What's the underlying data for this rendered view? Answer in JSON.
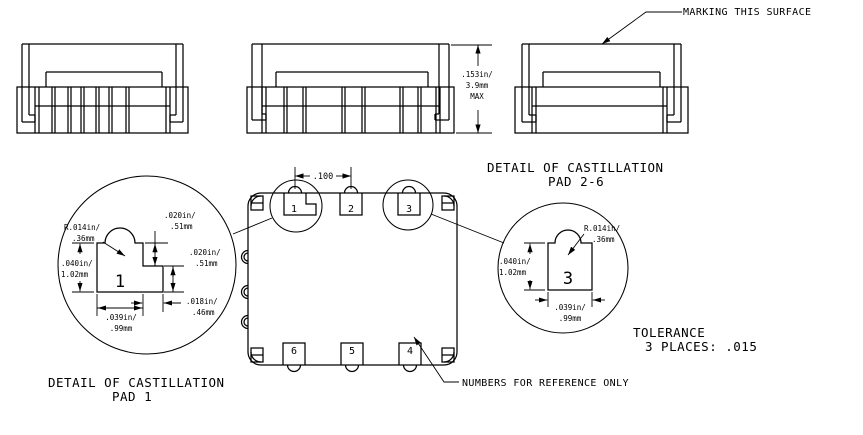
{
  "colors": {
    "line": "#000000",
    "background": "#ffffff"
  },
  "notes": {
    "marking": "MARKING THIS SURFACE",
    "reference": "NUMBERS FOR REFERENCE ONLY"
  },
  "tolerance": {
    "line1": "TOLERANCE",
    "line2": "3 PLACES: .015"
  },
  "height_dim": {
    "line1": ".153in/",
    "line2": "3.9mm",
    "line3": "MAX"
  },
  "pitch_dim": ".100",
  "plan_pads": {
    "p1": "1",
    "p2": "2",
    "p3": "3",
    "p4": "4",
    "p5": "5",
    "p6": "6"
  },
  "detail_pad1": {
    "title": "DETAIL OF CASTILLATION",
    "subtitle": "PAD 1",
    "pad_label": "1",
    "radius1": "R.014in/",
    "radius2": ".36mm",
    "notch_depth1": ".020in/",
    "notch_depth2": ".51mm",
    "step_height1": ".020in/",
    "step_height2": ".51mm",
    "height1": ".040in/",
    "height2": "1.02mm",
    "step_width1": ".018in/",
    "step_width2": ".46mm",
    "width1": ".039in/",
    "width2": ".99mm"
  },
  "detail_pad26": {
    "title": "DETAIL OF CASTILLATION",
    "subtitle": "PAD 2-6",
    "pad_label": "3",
    "radius1": "R.014in/",
    "radius2": ".36mm",
    "height1": ".040in/",
    "height2": "1.02mm",
    "width1": ".039in/",
    "width2": ".99mm"
  }
}
